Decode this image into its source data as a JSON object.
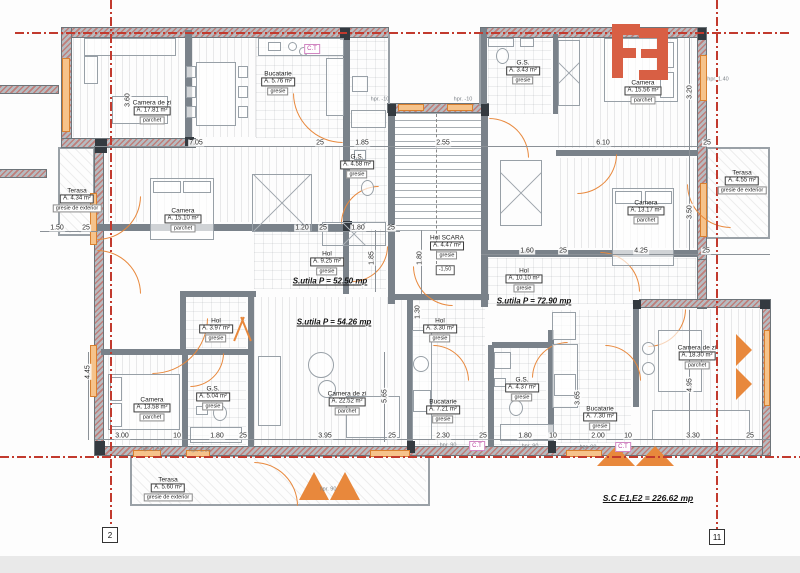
{
  "logo": {
    "text": "F3"
  },
  "colors": {
    "logo_red": "#d85f44",
    "joinery_orange": "#e8883c",
    "axis_red": "#c23a2e",
    "wall_gray": "#7a828a",
    "ct_magenta": "#b8479e"
  },
  "rooms": [
    {
      "id": "camera-de-zi-nv",
      "name": "Camera de zi",
      "area": "A. 17.81 m²",
      "floor": "parchet",
      "x": 152,
      "y": 112
    },
    {
      "id": "bucatarie-nv",
      "name": "Bucatarie",
      "area": "A. 5.76 m²",
      "floor": "gresie",
      "x": 278,
      "y": 83
    },
    {
      "id": "camera-nv",
      "name": "Camera",
      "area": "A. 15.10 m²",
      "floor": "parchet",
      "x": 183,
      "y": 220
    },
    {
      "id": "terasa-nv",
      "name": "Terasa",
      "area": "A. 4.34 m²",
      "floor": "gresie de exterior",
      "x": 77,
      "y": 200
    },
    {
      "id": "gs-nv",
      "name": "G.S.",
      "area": "A. 4.58 m²",
      "floor": "gresie",
      "x": 357,
      "y": 166
    },
    {
      "id": "hol-nv",
      "name": "Hol",
      "area": "A. 9.25 m²",
      "floor": "gresie",
      "x": 327,
      "y": 263
    },
    {
      "id": "hol-scara",
      "name": "Hol SCARA",
      "area": "A. 4.47 m²",
      "floor": "gresie",
      "x": 447,
      "y": 247
    },
    {
      "id": "gs-ne",
      "name": "G.S.",
      "area": "A. 3.43 m²",
      "floor": "gresie",
      "x": 523,
      "y": 72
    },
    {
      "id": "camera-ne-1",
      "name": "Camera",
      "area": "A. 15.56 m²",
      "floor": "parchet",
      "x": 643,
      "y": 92
    },
    {
      "id": "camera-ne-2",
      "name": "Camera",
      "area": "A. 13.17 m²",
      "floor": "parchet",
      "x": 646,
      "y": 212
    },
    {
      "id": "terasa-ne",
      "name": "Terasa",
      "area": "A. 4.55 m²",
      "floor": "gresie de exterior",
      "x": 742,
      "y": 182
    },
    {
      "id": "hol-ne",
      "name": "Hol",
      "area": "A. 10.10 m²",
      "floor": "gresie",
      "x": 524,
      "y": 280
    },
    {
      "id": "hol-sv",
      "name": "Hol",
      "area": "A. 3.97 m²",
      "floor": "gresie",
      "x": 216,
      "y": 330
    },
    {
      "id": "camera-sv",
      "name": "Camera",
      "area": "A. 13.58 m²",
      "floor": "parchet",
      "x": 152,
      "y": 409
    },
    {
      "id": "gs-sv",
      "name": "G.S.",
      "area": "A. 5.04 m²",
      "floor": "gresie",
      "x": 213,
      "y": 398
    },
    {
      "id": "camera-de-zi-s",
      "name": "Camera de zi",
      "area": "A. 22.52 m²",
      "floor": "parchet",
      "x": 347,
      "y": 403
    },
    {
      "id": "terasa-s",
      "name": "Terasa",
      "area": "A. 5.60 m²",
      "floor": "gresie de exterior",
      "x": 168,
      "y": 489
    },
    {
      "id": "hol-se",
      "name": "Hol",
      "area": "A. 3.30 m²",
      "floor": "gresie",
      "x": 440,
      "y": 330
    },
    {
      "id": "bucatarie-s",
      "name": "Bucatarie",
      "area": "A. 7.21 m²",
      "floor": "gresie",
      "x": 443,
      "y": 411
    },
    {
      "id": "gs-se",
      "name": "G.S.",
      "area": "A. 4.37 m²",
      "floor": "gresie",
      "x": 522,
      "y": 389
    },
    {
      "id": "bucatarie-se",
      "name": "Bucatarie",
      "area": "A. 7.30 m²",
      "floor": "gresie",
      "x": 600,
      "y": 418
    },
    {
      "id": "camera-de-zi-se",
      "name": "Camera de zi",
      "area": "A. 18.30 m²",
      "floor": "parchet",
      "x": 697,
      "y": 357
    }
  ],
  "summaries": [
    {
      "id": "sutila-nv",
      "text": "S.utila P = 52.50 mp",
      "x": 330,
      "y": 281,
      "big": false
    },
    {
      "id": "sutila-s",
      "text": "S.utila P = 54.26 mp",
      "x": 334,
      "y": 322,
      "big": false
    },
    {
      "id": "sutila-ne",
      "text": "S.utila P = 72.90 mp",
      "x": 534,
      "y": 301,
      "big": false
    },
    {
      "id": "total",
      "text": "S.C E1,E2 = 226.62 mp",
      "x": 648,
      "y": 498,
      "big": true
    }
  ],
  "dimensions": {
    "horizontal": [
      {
        "t": "7.05",
        "x": 196,
        "y": 143
      },
      {
        "t": "25",
        "x": 320,
        "y": 143
      },
      {
        "t": "1.85",
        "x": 362,
        "y": 143
      },
      {
        "t": "2.55",
        "x": 443,
        "y": 143
      },
      {
        "t": "6.10",
        "x": 603,
        "y": 143
      },
      {
        "t": "25",
        "x": 707,
        "y": 143
      },
      {
        "t": "1.50",
        "x": 57,
        "y": 228
      },
      {
        "t": "25",
        "x": 86,
        "y": 228
      },
      {
        "t": "1.20",
        "x": 302,
        "y": 228
      },
      {
        "t": "25",
        "x": 323,
        "y": 228
      },
      {
        "t": "1.80",
        "x": 358,
        "y": 228
      },
      {
        "t": "25",
        "x": 391,
        "y": 228
      },
      {
        "t": "1.60",
        "x": 527,
        "y": 251
      },
      {
        "t": "25",
        "x": 563,
        "y": 251
      },
      {
        "t": "4.25",
        "x": 641,
        "y": 251
      },
      {
        "t": "25",
        "x": 706,
        "y": 251
      },
      {
        "t": "3.00",
        "x": 122,
        "y": 436
      },
      {
        "t": "10",
        "x": 177,
        "y": 436
      },
      {
        "t": "1.80",
        "x": 217,
        "y": 436
      },
      {
        "t": "25",
        "x": 243,
        "y": 436
      },
      {
        "t": "3.95",
        "x": 325,
        "y": 436
      },
      {
        "t": "25",
        "x": 392,
        "y": 436
      },
      {
        "t": "2.30",
        "x": 443,
        "y": 436
      },
      {
        "t": "25",
        "x": 483,
        "y": 436
      },
      {
        "t": "1.80",
        "x": 525,
        "y": 436
      },
      {
        "t": "10",
        "x": 553,
        "y": 436
      },
      {
        "t": "2.00",
        "x": 598,
        "y": 436
      },
      {
        "t": "10",
        "x": 628,
        "y": 436
      },
      {
        "t": "3.30",
        "x": 693,
        "y": 436
      },
      {
        "t": "25",
        "x": 750,
        "y": 436
      }
    ],
    "vertical": [
      {
        "t": "3.60",
        "x": 128,
        "y": 100
      },
      {
        "t": "3.20",
        "x": 690,
        "y": 92
      },
      {
        "t": "3.50",
        "x": 690,
        "y": 212
      },
      {
        "t": "1.85",
        "x": 372,
        "y": 258
      },
      {
        "t": "1.80",
        "x": 420,
        "y": 258
      },
      {
        "t": "1.30",
        "x": 418,
        "y": 312
      },
      {
        "t": "4.45",
        "x": 88,
        "y": 372
      },
      {
        "t": "5.65",
        "x": 385,
        "y": 396
      },
      {
        "t": "3.65",
        "x": 578,
        "y": 398
      },
      {
        "t": "4.95",
        "x": 690,
        "y": 385
      }
    ]
  },
  "annotations": [
    {
      "t": "hpr. -10",
      "x": 380,
      "y": 100
    },
    {
      "t": "hpr. -10",
      "x": 463,
      "y": 100
    },
    {
      "t": "hpr. 1.40",
      "x": 718,
      "y": 80
    },
    {
      "t": "hpr. 1.55",
      "x": 152,
      "y": 450
    },
    {
      "t": "hpr. 1.35",
      "x": 200,
      "y": 451
    },
    {
      "t": "hpr. 90",
      "x": 448,
      "y": 446
    },
    {
      "t": "hpr. 90",
      "x": 530,
      "y": 447
    },
    {
      "t": "hpr. 90",
      "x": 588,
      "y": 448
    },
    {
      "t": "hpr. 90",
      "x": 328,
      "y": 490
    }
  ],
  "ct": {
    "label": "C.T",
    "boxes": [
      {
        "x": 312,
        "y": 49
      },
      {
        "x": 477,
        "y": 446
      },
      {
        "x": 623,
        "y": 447
      }
    ]
  },
  "level_marker": {
    "text": "-1,50",
    "x": 445,
    "y": 270
  },
  "axis_bubbles": [
    {
      "label": "2",
      "x": 102,
      "y": 527
    },
    {
      "label": "11",
      "x": 709,
      "y": 529
    }
  ]
}
